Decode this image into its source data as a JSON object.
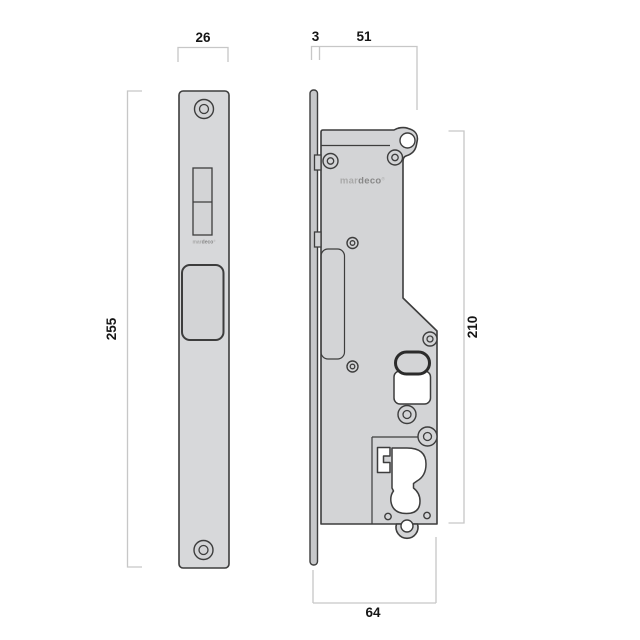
{
  "colors": {
    "outline": "#3d3d3d",
    "part_fill": "#d3d4d6",
    "plate_fill": "#d7d8da",
    "facebar_fill": "#c7c8ca",
    "cutout_fill": "#ffffff",
    "pill_stroke": "#2b2b2b",
    "dim_line": "#c7c7c7",
    "label": "#161616",
    "logo_light": "#a9a9a9",
    "logo_bold": "#888888"
  },
  "diagram": {
    "views": {
      "front": {
        "labels": {
          "width": "26",
          "height": "255"
        },
        "logo": {
          "light": "mar",
          "bold": "deco",
          "mark": "®"
        }
      },
      "side": {
        "labels": {
          "faceplate_thickness": "3",
          "case_width": "51",
          "case_height": "210",
          "overall_width": "64"
        },
        "logo": {
          "light": "mar",
          "bold": "deco",
          "mark": "®"
        }
      }
    }
  }
}
